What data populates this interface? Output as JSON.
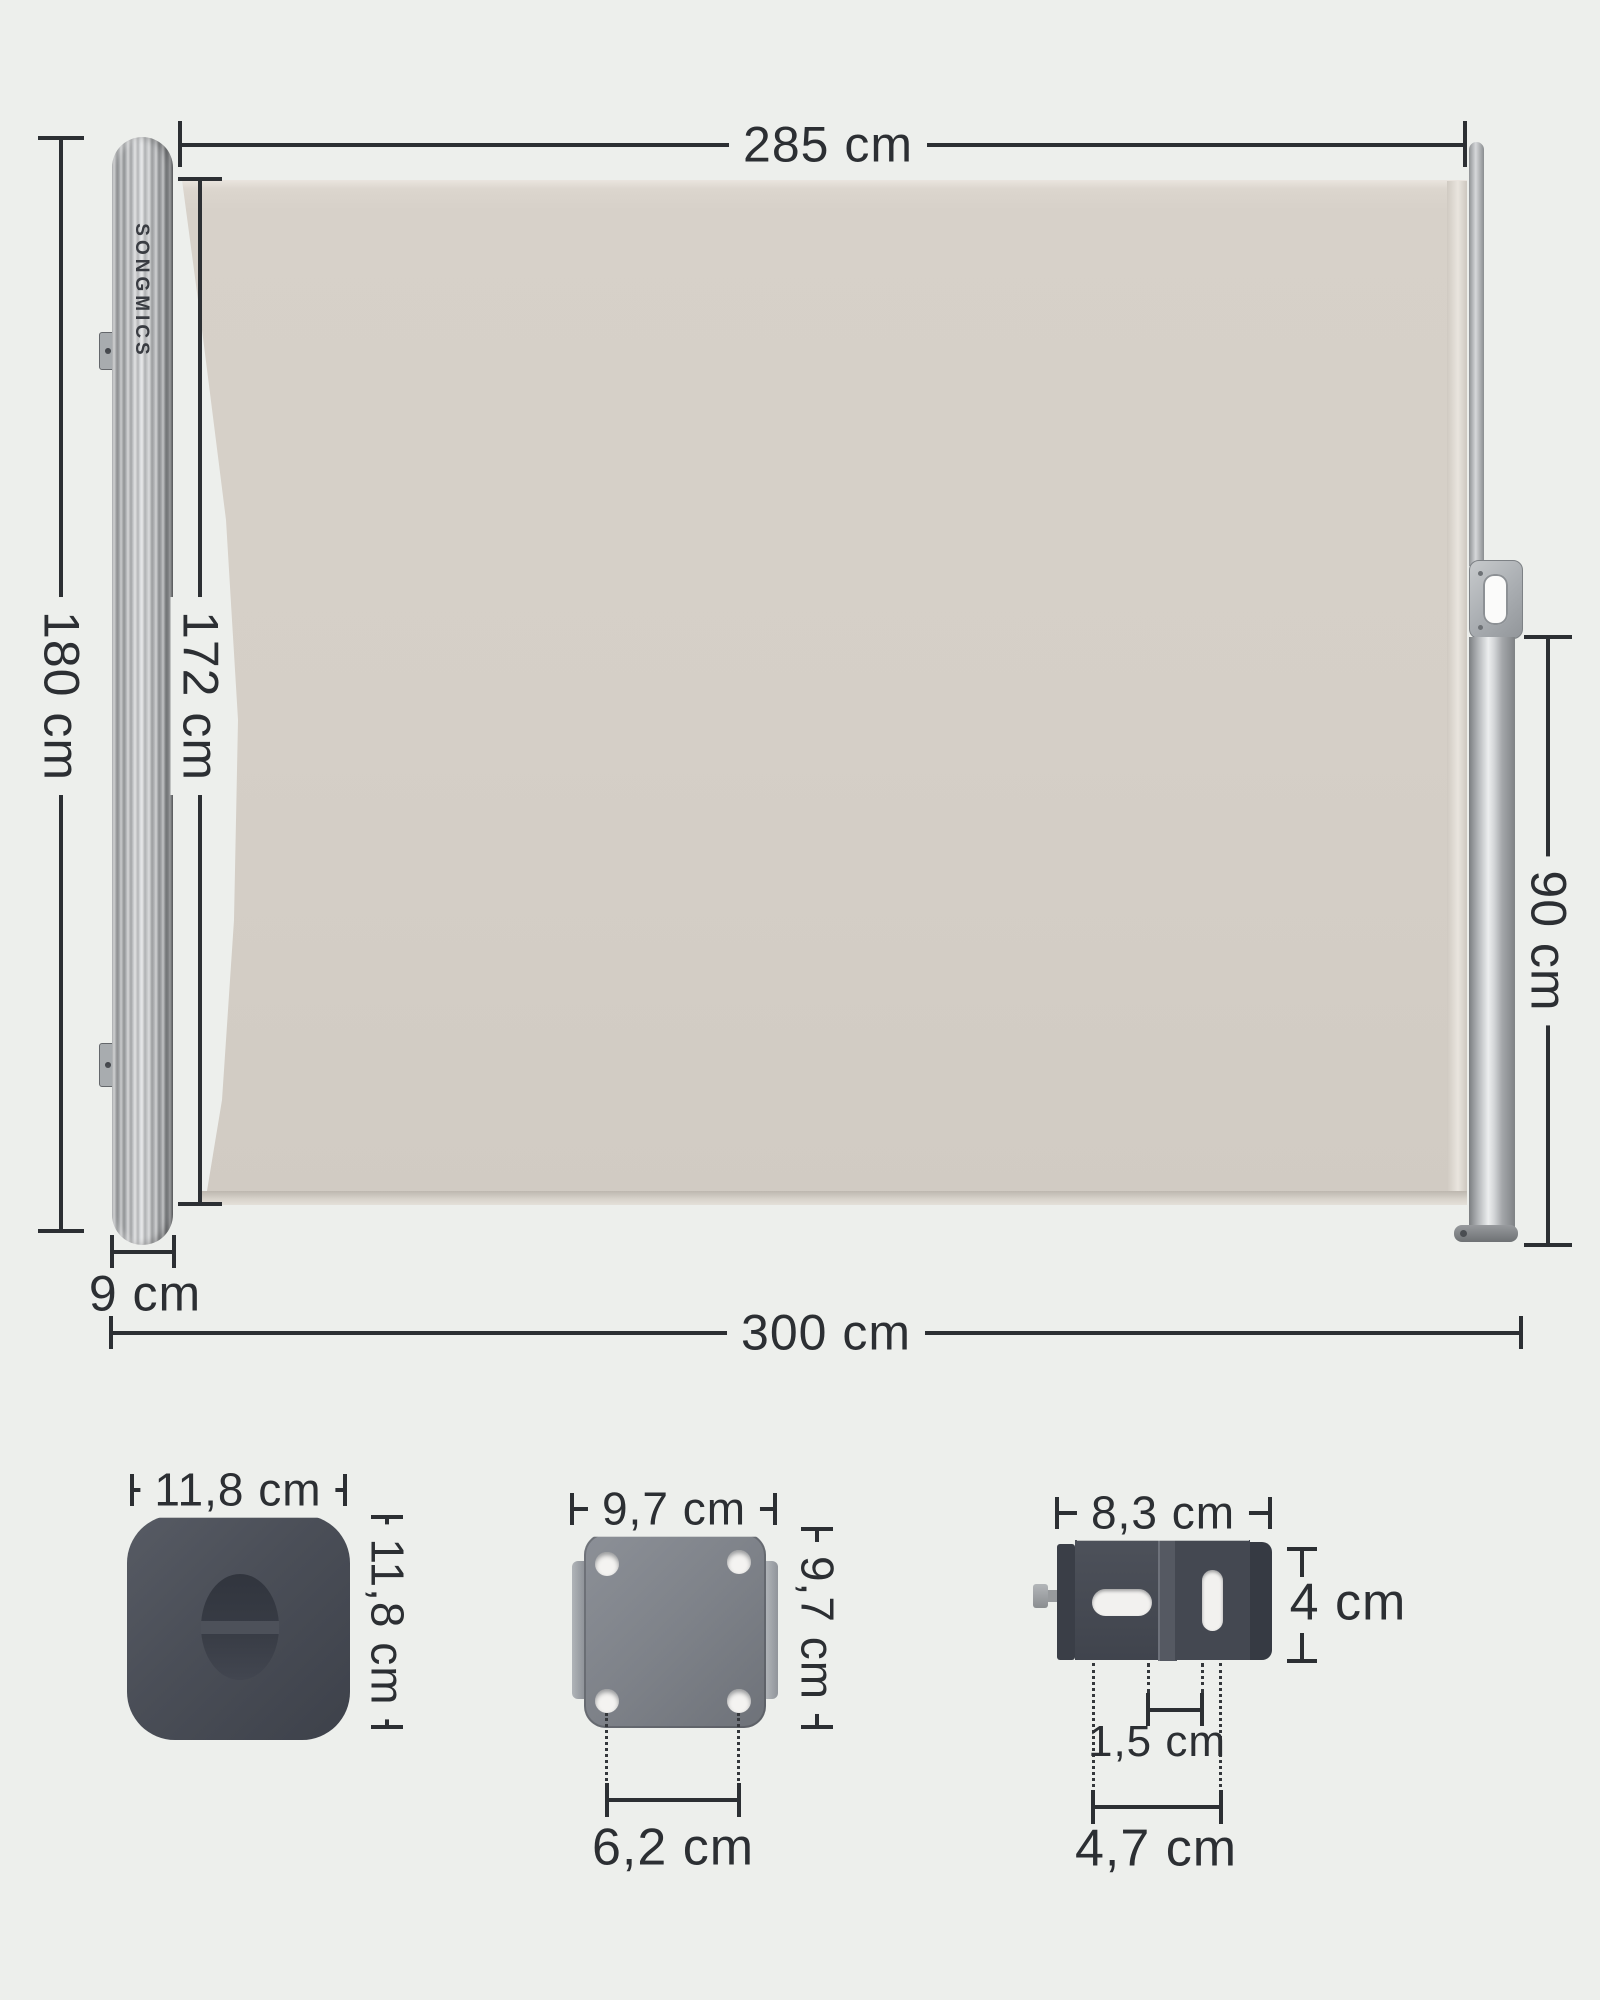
{
  "page": {
    "background": "#edefec"
  },
  "brand": {
    "logo_text": "SONGMICS"
  },
  "awning": {
    "fabric_color": "#d5cfc7",
    "accent_line_color": "#2c2f33",
    "labels": {
      "fabric_width": "285 cm",
      "total_height": "180 cm",
      "fabric_height": "172 cm",
      "right_post_height": "90 cm",
      "cassette_depth": "9 cm",
      "total_width": "300 cm"
    }
  },
  "parts": {
    "corner_cap": {
      "width": "11,8 cm",
      "height": "11,8 cm"
    },
    "mounting_plate": {
      "width": "9,7 cm",
      "height": "9,7 cm",
      "hole_spacing": "6,2 cm"
    },
    "floor_bracket": {
      "width": "8,3 cm",
      "height": "4 cm",
      "slot_offset": "1,5 cm",
      "hole_spacing": "4,7 cm"
    }
  }
}
